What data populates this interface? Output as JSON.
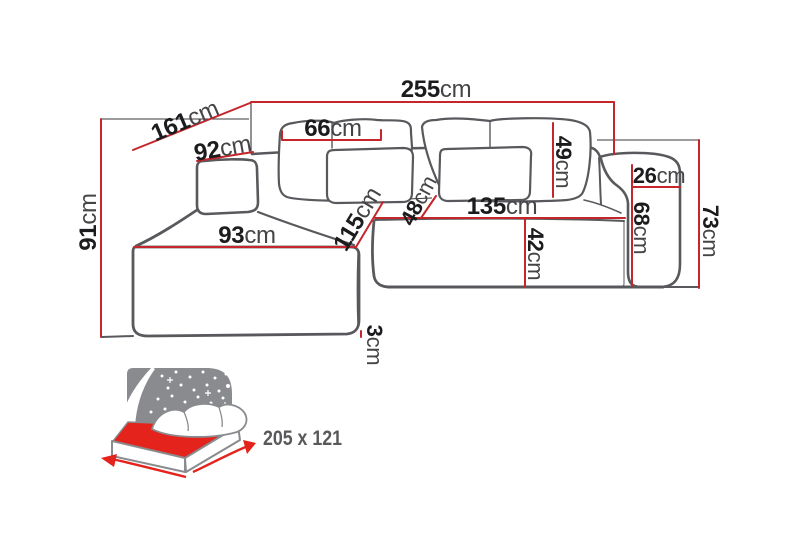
{
  "diagram_title": "corner-sofa-dimension-diagram",
  "colors": {
    "dimension_line": "#c5262c",
    "sofa_outline": "#58595c",
    "label_number": "#1c1c1e",
    "label_unit": "#454547",
    "bed_icon_red": "#e4231c",
    "bed_icon_gray": "#8a8b8e",
    "sleeping_text": "#58595b",
    "background": "#ffffff"
  },
  "dimensions": {
    "d255": {
      "num": "255",
      "unit": "cm"
    },
    "d161": {
      "num": "161",
      "unit": "cm"
    },
    "d91": {
      "num": "91",
      "unit": "cm"
    },
    "d92": {
      "num": "92",
      "unit": "cm"
    },
    "d66": {
      "num": "66",
      "unit": "cm"
    },
    "d49": {
      "num": "49",
      "unit": "cm"
    },
    "d93": {
      "num": "93",
      "unit": "cm"
    },
    "d115": {
      "num": "115",
      "unit": "cm"
    },
    "d48": {
      "num": "48",
      "unit": "cm"
    },
    "d135": {
      "num": "135",
      "unit": "cm"
    },
    "d42": {
      "num": "42",
      "unit": "cm"
    },
    "d26": {
      "num": "26",
      "unit": "cm"
    },
    "d68": {
      "num": "68",
      "unit": "cm"
    },
    "d73": {
      "num": "73",
      "unit": "cm"
    },
    "d3": {
      "num": "3",
      "unit": "cm"
    }
  },
  "sleeping_area": {
    "label": "205 x 121"
  }
}
